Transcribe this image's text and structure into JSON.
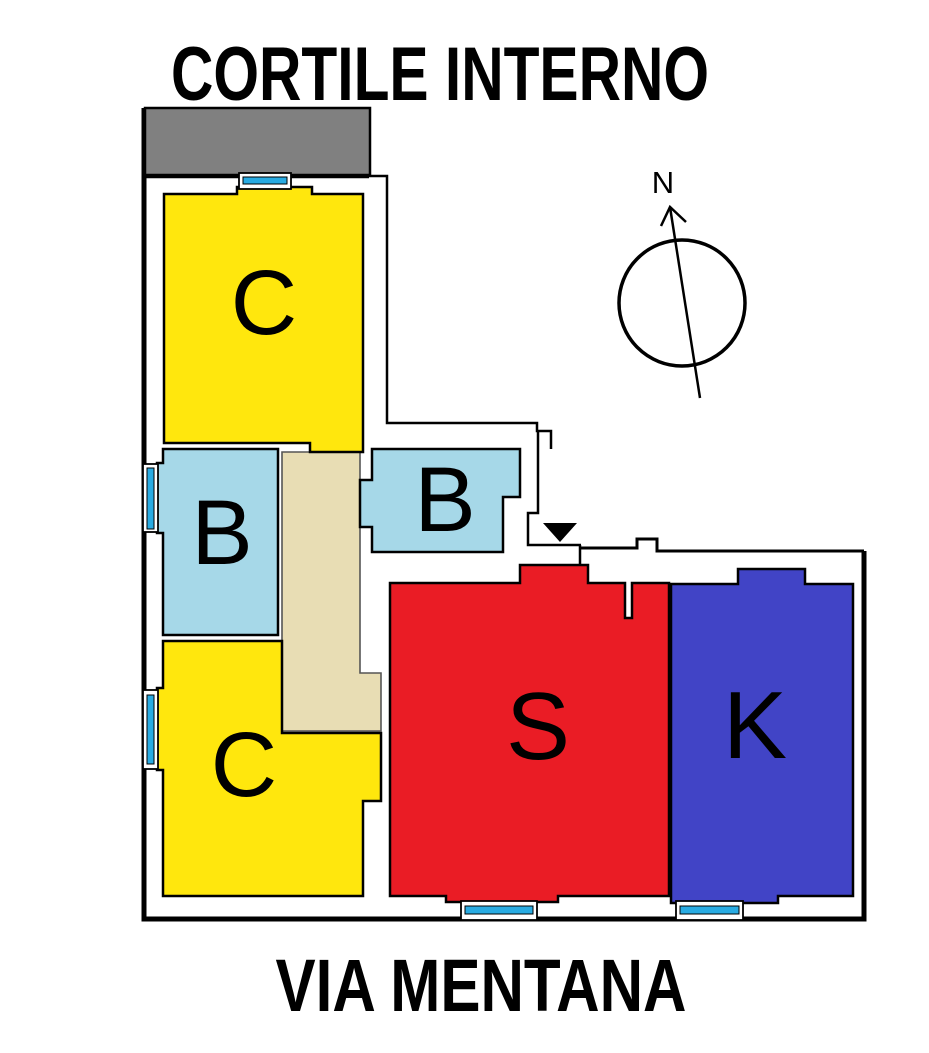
{
  "titles": {
    "top": "CORTILE INTERNO",
    "bottom": "VIA MENTANA"
  },
  "compass": {
    "north_label": "N"
  },
  "rooms": [
    {
      "id": "room-c-upper",
      "label": "C",
      "color": "#ffe70d"
    },
    {
      "id": "room-b-left",
      "label": "B",
      "color": "#a6d8e8"
    },
    {
      "id": "room-b-right",
      "label": "B",
      "color": "#a6d8e8"
    },
    {
      "id": "room-c-lower",
      "label": "C",
      "color": "#ffe70d"
    },
    {
      "id": "room-s",
      "label": "S",
      "color": "#ea1c25"
    },
    {
      "id": "room-k",
      "label": "K",
      "color": "#4144c6"
    }
  ],
  "corridor": {
    "color": "#e8ddb4"
  },
  "terrace": {
    "color": "#808080"
  },
  "window": {
    "glass_color": "#29abe2"
  },
  "entrance": {
    "marker_color": "#000000"
  }
}
